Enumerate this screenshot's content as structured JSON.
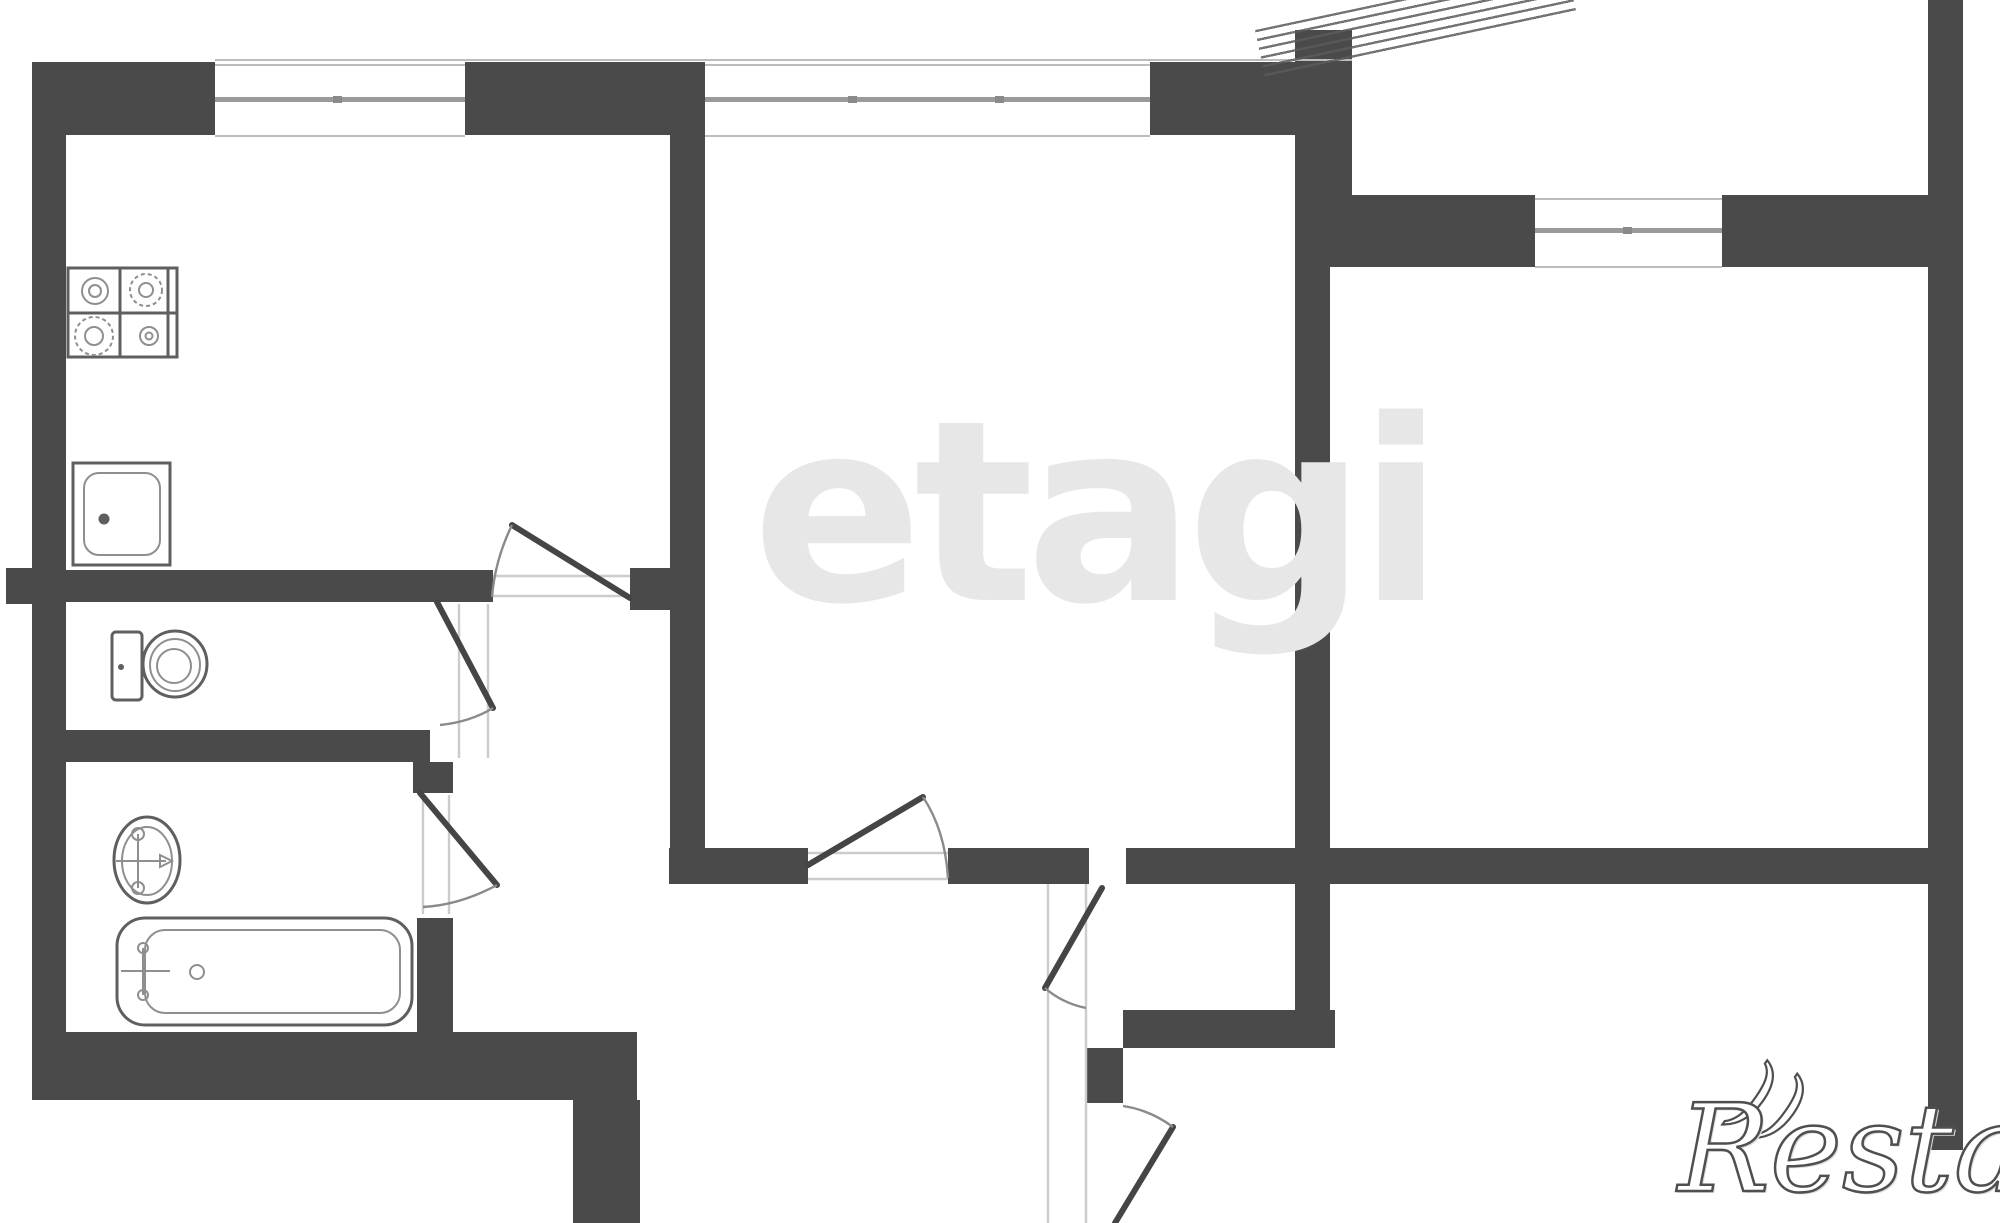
{
  "title": "apartment floor plan",
  "watermarks": {
    "brand_center": "etagi",
    "brand_corner": "Restate",
    "brand_corner_swoosh": "))"
  },
  "colors": {
    "wall": "#4a4a4a",
    "background": "#ffffff",
    "watermark_center": "#e7e7e7",
    "watermark_corner_stroke": "#4f4f4f",
    "window_line": "#9a9a9a",
    "fixture_line": "#5f5f5f",
    "frame_line": "#cccccc",
    "sill_line": "#bdbdbd"
  },
  "elements": {
    "windows": [
      "kitchen-window",
      "living-room-window",
      "entry-side-window"
    ],
    "doors": [
      "kitchen-door",
      "toilet-door",
      "bathroom-door",
      "living-room-door",
      "corridor-upper-door",
      "corridor-lower-door"
    ],
    "fixtures": [
      "stove",
      "kitchen-sink",
      "toilet",
      "washbasin",
      "bathtub"
    ],
    "stairs": "entry-stairs-hatch"
  }
}
